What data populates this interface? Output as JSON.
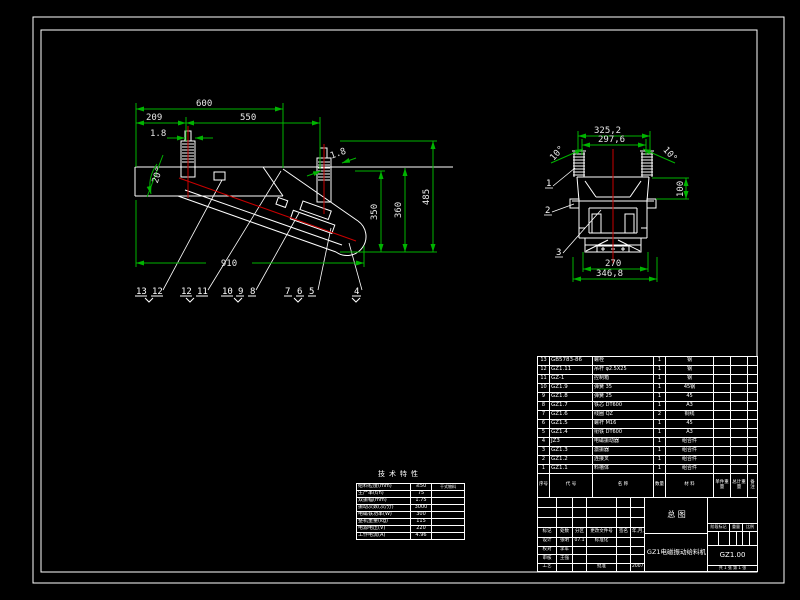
{
  "sheet": {
    "background": "#000000",
    "geometry_color": "#ffffff",
    "dimension_color": "#00b400",
    "centerline_color": "#c80000"
  },
  "main_view": {
    "dim_total_top": "600",
    "dim_left": "209",
    "dim_mid": "550",
    "dim_gap_front": "1.8",
    "dim_gap_rear": "1.8",
    "dim_angle": "20°",
    "dim_length_bottom": "910",
    "dim_h_350": "350",
    "dim_h_360": "360",
    "dim_h_485": "485",
    "callout_groups": [
      [
        "13",
        "12"
      ],
      [
        "12",
        "11"
      ],
      [
        "10",
        "9",
        "8"
      ],
      [
        "7",
        "6",
        "5"
      ],
      [
        "4"
      ]
    ]
  },
  "end_view": {
    "dim_w_outer": "325,2",
    "dim_w_inner": "297,6",
    "dim_angle_left": "10°",
    "dim_angle_right": "10°",
    "dim_h_100": "100",
    "dim_w_270": "270",
    "dim_w_base": "346,8",
    "callouts": [
      "1",
      "2",
      "3"
    ]
  },
  "tech_table": {
    "title": "技术特性",
    "rows": [
      [
        "给料粒度(mm)",
        "≤50",
        "干式物料"
      ],
      [
        "生产率(t/h)",
        "75",
        ""
      ],
      [
        "双振幅(mm)",
        "1.75",
        ""
      ],
      [
        "振动次数(次/分)",
        "3000",
        ""
      ],
      [
        "电磁铁功率(W)",
        "300",
        ""
      ],
      [
        "整机重量(kg)",
        "115",
        ""
      ],
      [
        "电源电压(V)",
        "220",
        ""
      ],
      [
        "工作电流(A)",
        "4.96",
        ""
      ]
    ]
  },
  "parts_list": {
    "headers": [
      "序号",
      "代 号",
      "名 称",
      "数量",
      "材 料",
      "单件重量",
      "总计重量",
      "备注"
    ],
    "rows": [
      [
        "13",
        "GB5783-86",
        "螺栓",
        "1",
        "钢",
        "",
        "",
        ""
      ],
      [
        "12",
        "GZ1.11",
        "吊杆 φ2.5X25",
        "1",
        "钢",
        "",
        "",
        ""
      ],
      [
        "11",
        "GZ-1",
        "控制箱",
        "1",
        "钢",
        "",
        "",
        ""
      ],
      [
        "10",
        "GZ1.9",
        "弹簧 35",
        "1",
        "45钢",
        "",
        "",
        ""
      ],
      [
        "9",
        "GZ1.8",
        "弹簧 25",
        "1",
        "45",
        "",
        "",
        ""
      ],
      [
        "8",
        "GZ1.7",
        "铁芯 DT600",
        "1",
        "A3",
        "",
        "",
        ""
      ],
      [
        "7",
        "GZ1.6",
        "线圈 QZ",
        "2",
        "铜线",
        "",
        "",
        ""
      ],
      [
        "6",
        "GZ1.5",
        "螺杆 M16",
        "1",
        "45",
        "",
        "",
        ""
      ],
      [
        "5",
        "GZ1.4",
        "衔铁 DT600",
        "1",
        "A3",
        "",
        "",
        ""
      ],
      [
        "4",
        "JZ3",
        "电磁振动器",
        "1",
        "组合件",
        "",
        "",
        ""
      ],
      [
        "3",
        "GZ1.3",
        "激振器",
        "1",
        "组合件",
        "",
        "",
        ""
      ],
      [
        "2",
        "GZ1.2",
        "连接叉",
        "1",
        "组合件",
        "",
        "",
        ""
      ],
      [
        "1",
        "GZ1.1",
        "料槽体",
        "1",
        "组合件",
        "",
        "",
        ""
      ]
    ]
  },
  "title_block": {
    "revision_headers": [
      "标记",
      "处数",
      "分区",
      "更改文件号",
      "签名",
      "年,月,日"
    ],
    "sign_rows": [
      [
        "设计",
        "张明",
        "07.1",
        "标准化",
        "",
        ""
      ],
      [
        "校对",
        "李军",
        "",
        "",
        "",
        ""
      ],
      [
        "审核",
        "王强",
        "",
        "",
        "",
        ""
      ],
      [
        "工艺",
        "",
        "",
        "批准",
        "",
        "2007.1"
      ]
    ],
    "view_label": "总  图",
    "product_name": "GZ1电磁振动给料机",
    "drawing_no": "GZ1.00",
    "stage_headers": [
      "阶段标记",
      "重量",
      "比例"
    ],
    "sheet_info": "共 1 张  第 1 张"
  }
}
